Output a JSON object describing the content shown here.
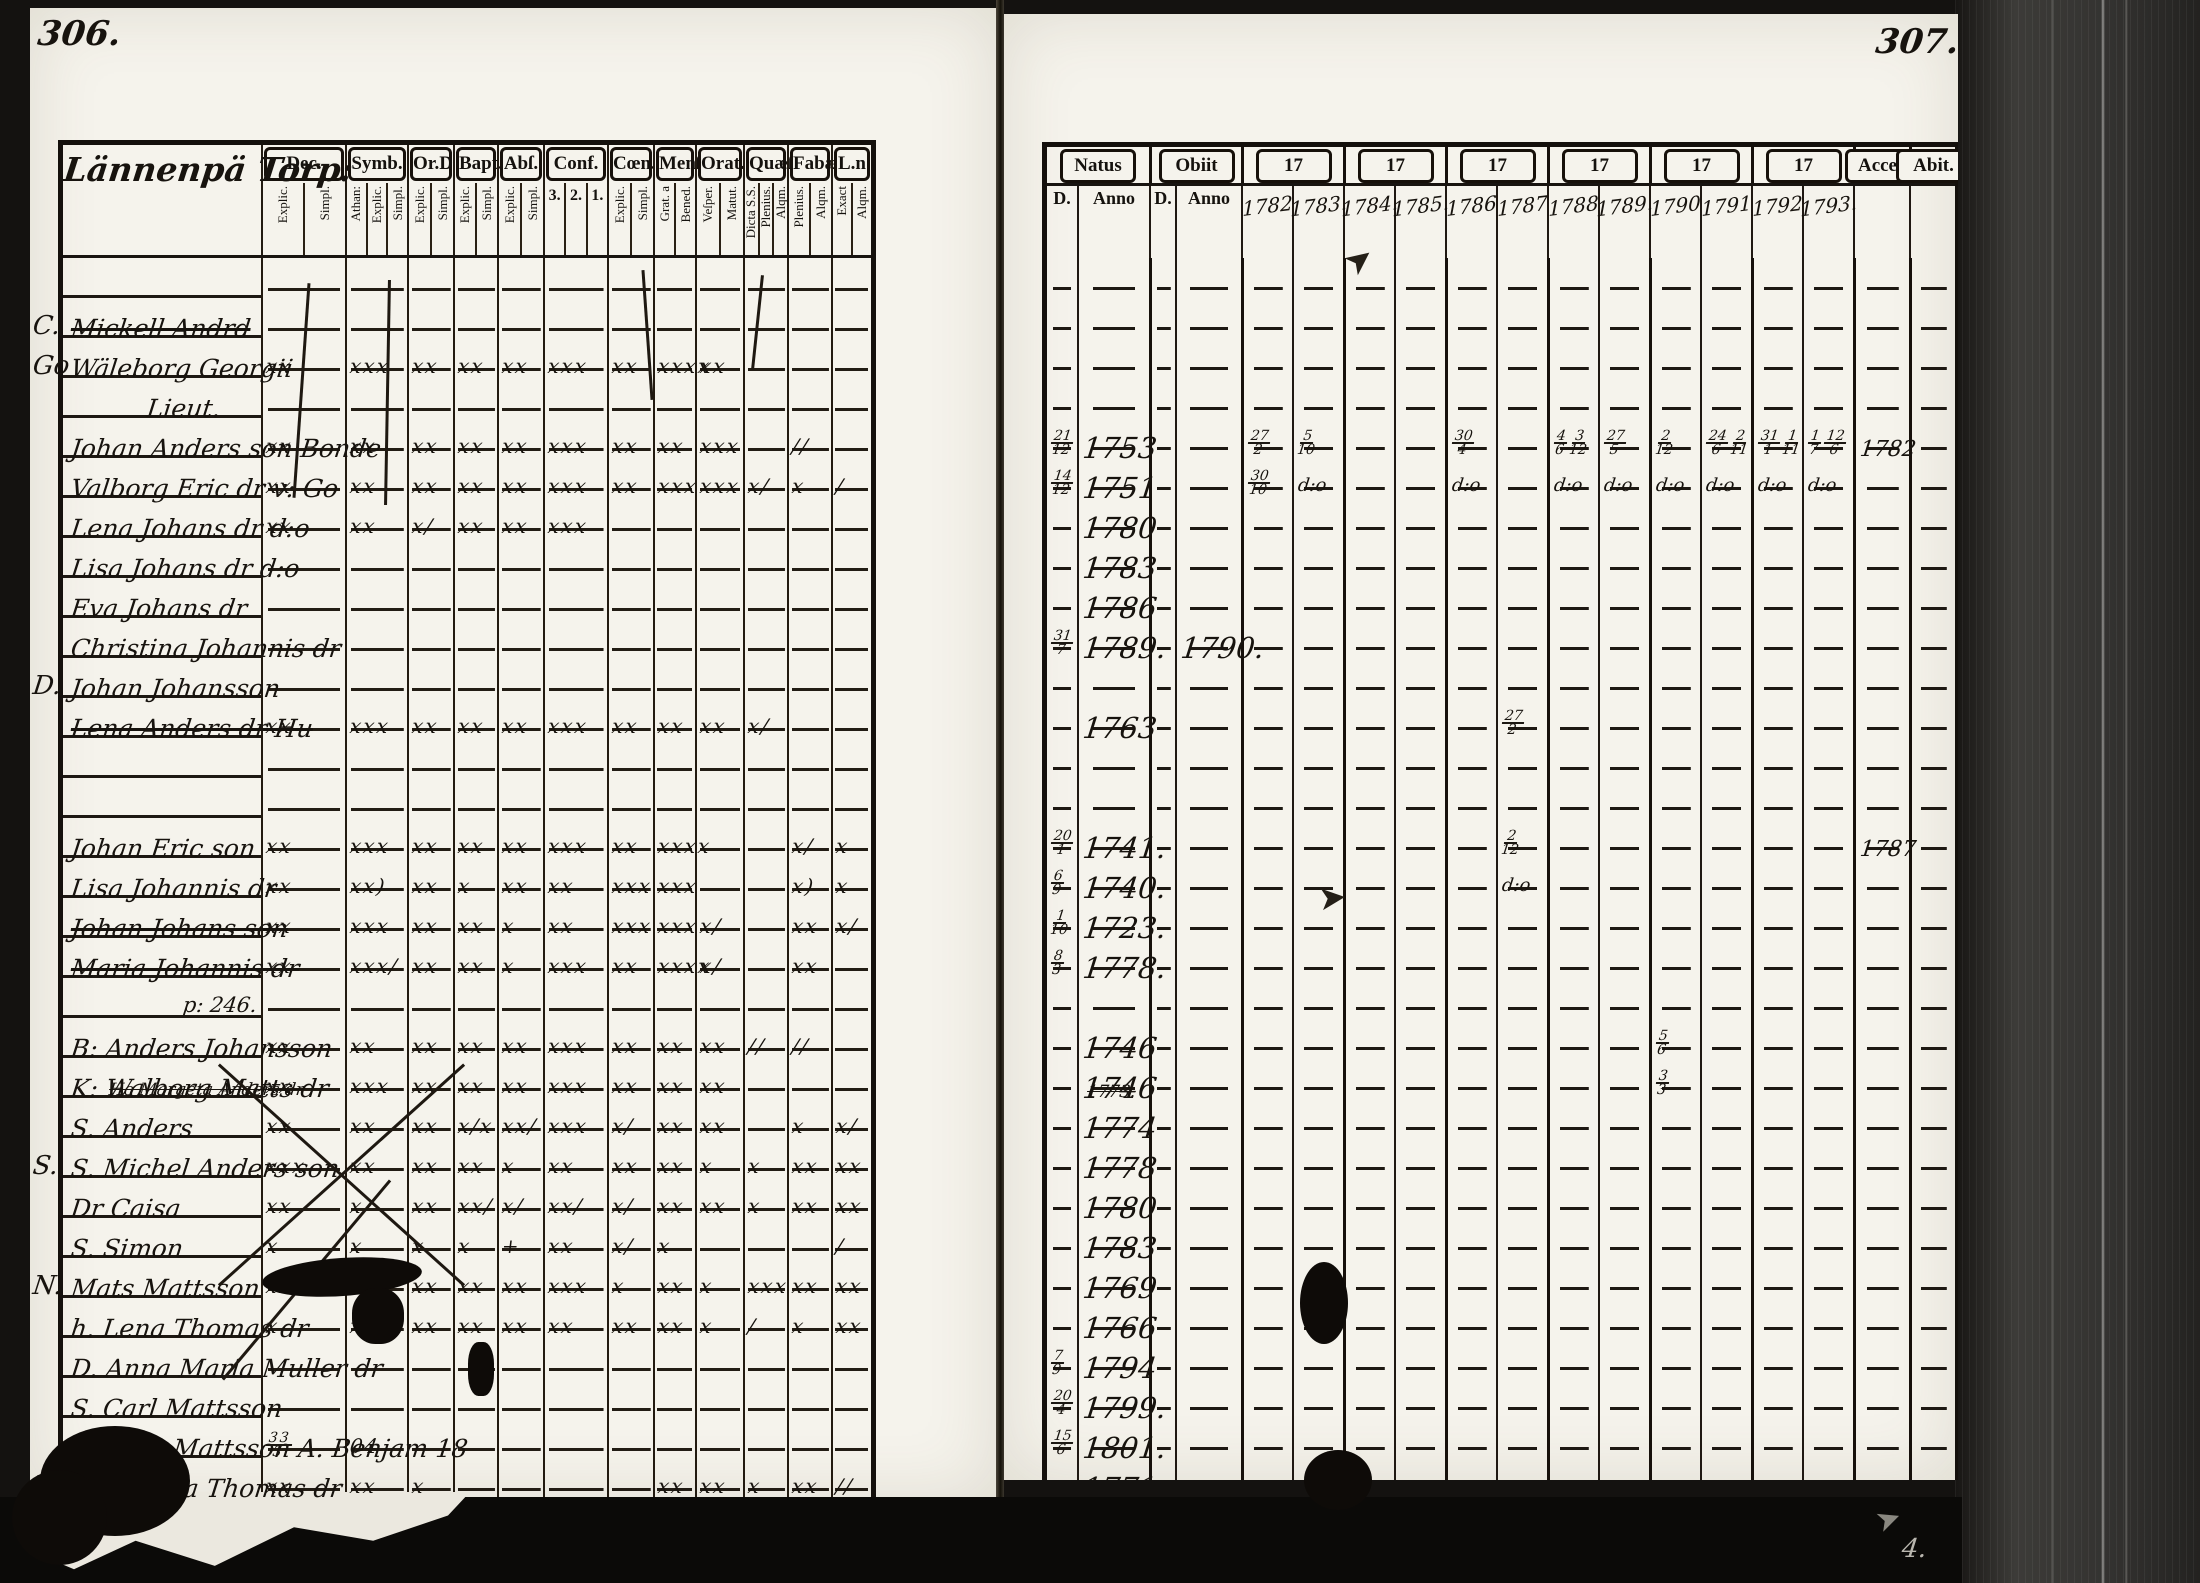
{
  "film": {
    "left_page_number": "306.",
    "right_page_number": "307.",
    "corner_mark": "4."
  },
  "left_page": {
    "title": "Lännenpä Torp:",
    "columns": [
      {
        "label": "Dec.",
        "subs": [
          "Explic.",
          "Simpl."
        ]
      },
      {
        "label": "Symb.",
        "subs": [
          "Athan:",
          "Explic.",
          "Simpl."
        ]
      },
      {
        "label": "Or.D",
        "subs": [
          "Explic.",
          "Simpl."
        ]
      },
      {
        "label": "Bapt.",
        "subs": [
          "Explic.",
          "Simpl."
        ]
      },
      {
        "label": "Abſ.",
        "subs": [
          "Explic.",
          "Simpl."
        ]
      },
      {
        "label": "Conf.",
        "subs": [
          "3.",
          "2.",
          "1."
        ]
      },
      {
        "label": "Cœn.D",
        "subs": [
          "Explic.",
          "Simpl."
        ]
      },
      {
        "label": "Menſ.",
        "subs": [
          "Grat. a",
          "Bened."
        ]
      },
      {
        "label": "Orat.",
        "subs": [
          "Veſper.",
          "Matut."
        ]
      },
      {
        "label": "Quæſl.",
        "subs": [
          "Dicta S.S.",
          "Plenius.",
          "Alqm."
        ]
      },
      {
        "label": "Fabæ",
        "subs": [
          "Plenius.",
          "Alqm."
        ]
      },
      {
        "label": "L.n",
        "subs": [
          "Exact",
          "Alqm."
        ]
      }
    ]
  },
  "right_page": {
    "natus_label": "Natus",
    "obiit_label": "Obiit",
    "day_label": "D.",
    "anno_label": "Anno",
    "decade_label": "17",
    "acces_label": "Acceſ.",
    "abit_label": "Abit.",
    "years": [
      "1782",
      "1783.",
      "1784.",
      "1785.",
      "1786",
      "1787",
      "1788",
      "1789.",
      "1790",
      "1791",
      "1792",
      "1793."
    ]
  },
  "rows": [
    {},
    {
      "m": "C.",
      "name": "Mickell Andrd",
      "strike": true
    },
    {
      "m": "Go",
      "name": "Wäleborg Georgii",
      "marks": [
        "xx",
        "xxx",
        "xx",
        "xx",
        "xx",
        "xxx",
        "xx",
        "xxxx",
        "xx",
        "",
        "",
        ""
      ]
    },
    {
      "name": "Lieut.",
      "center": true
    },
    {
      "name": "Johan Anders son Bonde",
      "marks": [
        "xx",
        "xx",
        "xx",
        "xx",
        "xx",
        "xxx",
        "xx",
        "xx",
        "xxx",
        "",
        "//",
        ""
      ],
      "d": "21/12",
      "anno": "1753",
      "years": [
        "27/2",
        "5/10",
        "",
        "",
        "30/4",
        "",
        "4/6 3/12",
        "27/5",
        "2/12",
        "24/6 2/11",
        "31/1 1/11",
        "1/7 12/6"
      ],
      "acces": "1782"
    },
    {
      "name": "Valborg Eric dr v: Go",
      "marks": [
        "xx",
        "xx",
        "xx",
        "xx",
        "xx",
        "xxx",
        "xx",
        "xxx",
        "xxx",
        "x/",
        "x",
        "/"
      ],
      "d": "14/12",
      "anno": "1751",
      "years": [
        "30/10",
        "d:o",
        "",
        "",
        "d:o",
        "",
        "d:o",
        "d:o",
        "d:o",
        "d:o",
        "d:o",
        "d:o"
      ]
    },
    {
      "name": "Lena Johans dr d:o",
      "marks": [
        "xx",
        "xx",
        "x/",
        "xx",
        "xx",
        "xxx",
        "",
        "",
        "",
        "",
        "",
        ""
      ],
      "anno": "1780"
    },
    {
      "name": "Lisa Johans dr d:o",
      "anno": "1783"
    },
    {
      "name": "Eva Johans dr",
      "anno": "1786"
    },
    {
      "name": "Christina Johannis dr",
      "d": "31/7",
      "anno": "1789.",
      "oanno": "1790."
    },
    {
      "m": "D.",
      "name": "Johan Johansson"
    },
    {
      "name": "Lena Anders dr Hu",
      "strike": true,
      "marks": [
        "xx",
        "xxx",
        "xx",
        "xx",
        "xx",
        "xxx",
        "xx",
        "xx",
        "xx",
        "x/",
        "",
        ""
      ],
      "anno": "1763",
      "years": [
        "",
        "",
        "",
        "",
        "",
        "27/2",
        "",
        "",
        "",
        "",
        "",
        ""
      ]
    },
    {},
    {},
    {
      "name": "Johan Eric son",
      "marks": [
        "xx",
        "xxx",
        "xx",
        "xx",
        "xx",
        "xxx",
        "xx",
        "xxxx",
        "",
        "",
        "x/",
        "x"
      ],
      "d": "20/1",
      "anno": "1741.",
      "years": [
        "",
        "",
        "",
        "",
        "",
        "2/12",
        "",
        "",
        "",
        "",
        "",
        ""
      ],
      "acces": "1787"
    },
    {
      "name": "Lisa Johannis dr",
      "marks": [
        "xx",
        "xx)",
        "xx",
        "x",
        "xx",
        "xx",
        "xxx",
        "xxx",
        "",
        "",
        "x)",
        "x"
      ],
      "d": "6/9",
      "anno": "1740.",
      "years": [
        "",
        "",
        "",
        "",
        "",
        "d:o",
        "",
        "",
        "",
        "",
        "",
        ""
      ]
    },
    {
      "name": "Johan Johans son",
      "strike": true,
      "marks": [
        "xx",
        "xxx",
        "xx",
        "xx",
        "x",
        "xx",
        "xxx",
        "xxx",
        "x/",
        "",
        "xx",
        "x/"
      ],
      "d": "1/10",
      "anno": "1723."
    },
    {
      "name": "Maria Johannis dr",
      "strike": true,
      "marks": [
        "xx",
        "xxx/",
        "xx",
        "xx",
        "x",
        "xxx",
        "xx",
        "xxxx",
        "x/",
        "",
        "xx",
        ""
      ],
      "d": "8/3",
      "anno": "1778."
    },
    {
      "name": "p: 246.",
      "note": true
    },
    {
      "name": "B: Anders Johansson",
      "marks": [
        "xx",
        "xx",
        "xx",
        "xx",
        "xx",
        "xxx",
        "xx",
        "xx",
        "xx",
        "//",
        "//",
        ""
      ],
      "anno": "1746",
      "years": [
        "",
        "",
        "",
        "",
        "",
        "",
        "",
        "",
        "5/6",
        "",
        "",
        ""
      ]
    },
    {
      "name": "K: Walborg Matts dr",
      "marks": [
        "xx",
        "xxx",
        "xx",
        "xx",
        "xx",
        "xxx",
        "xx",
        "xx",
        "xx",
        "",
        "",
        ""
      ],
      "anno": "1746",
      "years": [
        "",
        "",
        "",
        "",
        "",
        "",
        "",
        "",
        "3/3",
        "",
        "",
        ""
      ]
    },
    {
      "name": "S. Anders",
      "prestrike": "Ho Margeta Anders dr",
      "marks": [
        "xx",
        "xx",
        "xx",
        "x/x",
        "xx/",
        "xxx",
        "x/",
        "xx",
        "xx",
        "",
        "x",
        "x/"
      ],
      "anno": "1774",
      "prev": "1773."
    },
    {
      "m": "S.",
      "name": "S. Michel  Anders son",
      "marks": [
        "xxx",
        "xx",
        "xx",
        "xx",
        "x",
        "xx",
        "xx",
        "xx",
        "x",
        "x",
        "xx",
        "xx"
      ],
      "anno": "1778"
    },
    {
      "name": "Dr Caisa",
      "marks": [
        "xx",
        "x",
        "xx",
        "xx/",
        "x/",
        "xx/",
        "x/",
        "xx",
        "xx",
        "x",
        "xx",
        "xx"
      ],
      "anno": "1780"
    },
    {
      "name": "S. Simon",
      "marks": [
        "x",
        "x",
        "x",
        "x",
        "+",
        "xx",
        "x/",
        "x",
        "",
        "",
        "",
        "/"
      ],
      "anno": "1783"
    },
    {
      "m": "N.",
      "name": "Mats Mattsson",
      "blot": true,
      "marks": [
        "xx",
        "xx",
        "xx",
        "xx",
        "xx",
        "xxx",
        "x",
        "xx",
        "x",
        "xxx",
        "xx",
        "xx"
      ],
      "anno": "1769"
    },
    {
      "name": "h. Lena Thomas dr",
      "marks": [
        "x",
        "xxx",
        "xx",
        "xx",
        "xx",
        "xx",
        "xx",
        "xx",
        "x",
        "/",
        "x",
        "xx"
      ],
      "anno": "1766"
    },
    {
      "name": "D. Anna Maria Muller dr",
      "d": "7/9",
      "anno": "1794"
    },
    {
      "name": "S. Carl Mattsson",
      "d": "20/4",
      "anno": "1799."
    },
    {
      "name": "S. Elias Mattsson  A. Benjam 18",
      "marks": [
        "33/3",
        "04",
        "",
        "",
        "",
        "",
        "",
        "",
        "",
        "",
        "",
        ""
      ],
      "d": "15/6",
      "anno": "1801."
    },
    {
      "m": "B.",
      "name": "Ho. Maria Thomas dr",
      "marks": [
        "xx",
        "xx",
        "x",
        "",
        "",
        "",
        "",
        "xx",
        "xx",
        "x",
        "xx",
        "//"
      ],
      "anno": "1771."
    }
  ]
}
